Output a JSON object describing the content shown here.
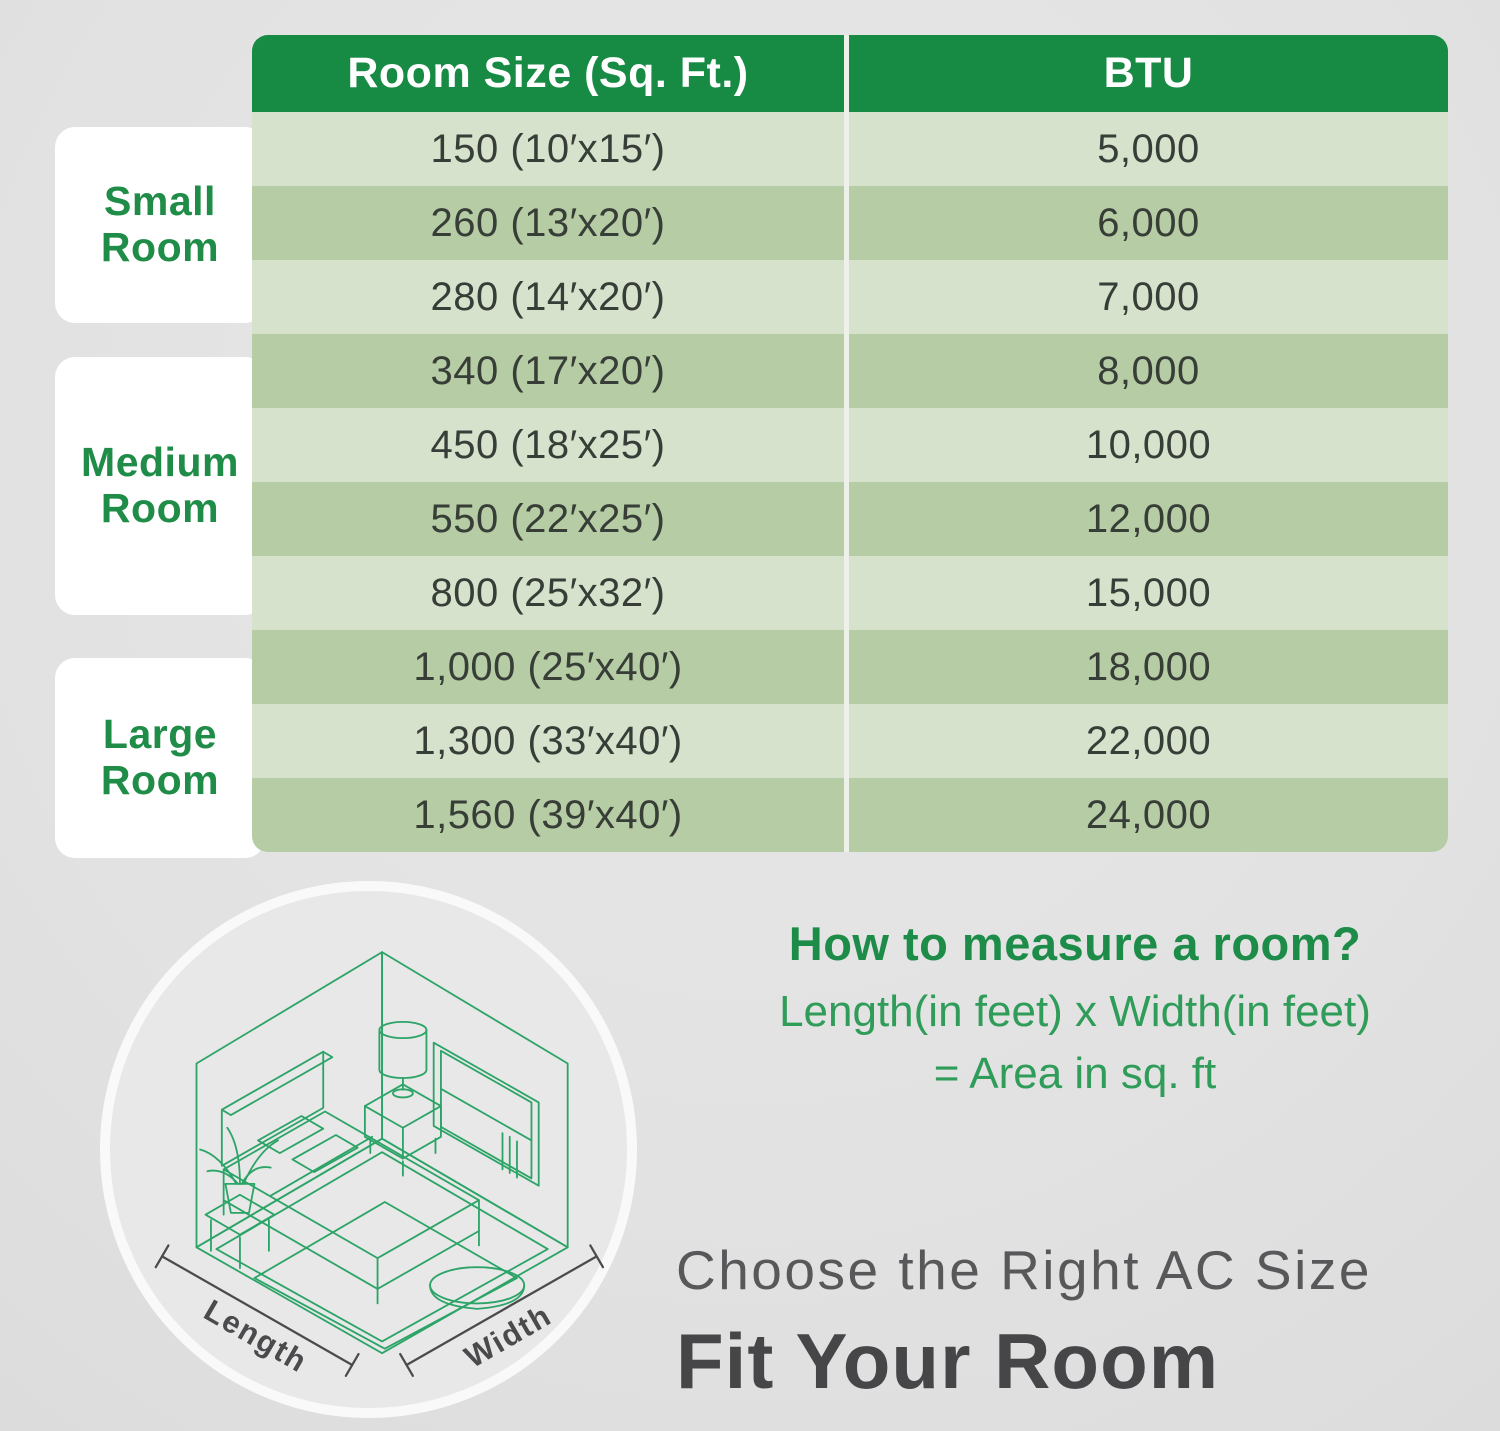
{
  "colors": {
    "background": "#e2e2e2",
    "header_green": "#178a44",
    "row_light": "#d7e2cc",
    "row_dark": "#b6cca4",
    "category_green": "#1f8c48",
    "formula_green": "#2f9c59",
    "illustration_green": "#2ca467",
    "subtitle_gray": "#58585b",
    "title_gray": "#464649"
  },
  "table": {
    "columns": [
      "Room Size (Sq. Ft.)",
      "BTU"
    ],
    "rows": [
      {
        "room_size": "150 (10′x15′)",
        "btu": "5,000"
      },
      {
        "room_size": "260 (13′x20′)",
        "btu": "6,000"
      },
      {
        "room_size": "280 (14′x20′)",
        "btu": "7,000"
      },
      {
        "room_size": "340 (17′x20′)",
        "btu": "8,000"
      },
      {
        "room_size": "450 (18′x25′)",
        "btu": "10,000"
      },
      {
        "room_size": "550 (22′x25′)",
        "btu": "12,000"
      },
      {
        "room_size": "800 (25′x32′)",
        "btu": "15,000"
      },
      {
        "room_size": "1,000 (25′x40′)",
        "btu": "18,000"
      },
      {
        "room_size": "1,300 (33′x40′)",
        "btu": "22,000"
      },
      {
        "room_size": "1,560 (39′x40′)",
        "btu": "24,000"
      }
    ]
  },
  "categories": [
    {
      "label": "Small\nRoom"
    },
    {
      "label": "Medium\nRoom"
    },
    {
      "label": "Large\nRoom"
    }
  ],
  "measure": {
    "heading": "How to measure a room?",
    "formula_line1": "Length(in feet) x Width(in feet)",
    "formula_line2": "= Area in sq. ft"
  },
  "illustration": {
    "length_label": "Length",
    "width_label": "Width"
  },
  "footer": {
    "subtitle": "Choose the Right AC Size",
    "title": "Fit Your Room"
  },
  "chart_data": {
    "type": "table",
    "title": "Room Size (Sq. Ft.) vs BTU",
    "columns": [
      "Room Size (Sq. Ft.)",
      "BTU"
    ],
    "room_size_sqft": [
      150,
      260,
      280,
      340,
      450,
      550,
      800,
      1000,
      1300,
      1560
    ],
    "room_dimensions_ft": [
      "10x15",
      "13x20",
      "14x20",
      "17x20",
      "18x25",
      "22x25",
      "25x32",
      "25x40",
      "33x40",
      "39x40"
    ],
    "btu": [
      5000,
      6000,
      7000,
      8000,
      10000,
      12000,
      15000,
      18000,
      22000,
      24000
    ],
    "row_groups": [
      {
        "label": "Small Room",
        "rows": [
          0,
          1,
          2
        ]
      },
      {
        "label": "Medium Room",
        "rows": [
          3,
          4,
          5,
          6
        ]
      },
      {
        "label": "Large Room",
        "rows": [
          7,
          8,
          9
        ]
      }
    ]
  }
}
